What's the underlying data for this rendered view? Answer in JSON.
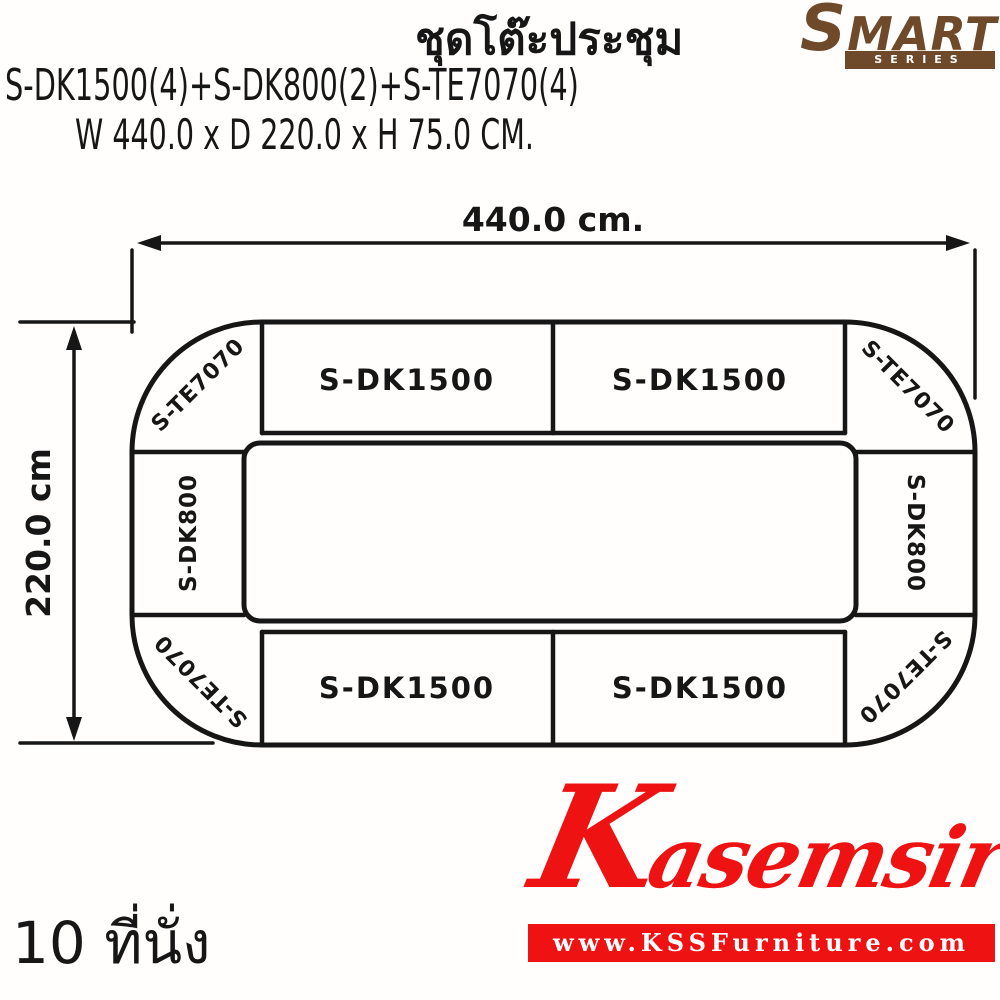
{
  "page": {
    "background_color": "#ffffff",
    "ink_color": "#161616"
  },
  "header": {
    "title": "ชุดโต๊ะประชุม",
    "product_code": "S-DK1500(4)+S-DK800(2)+S-TE7070(4)",
    "size_text": "W 440.0 x D 220.0 x H 75.0 CM.",
    "brand": {
      "name_initial": "S",
      "name_rest": "MART",
      "series": "SERIES",
      "color": "#6e4a2b"
    }
  },
  "diagram": {
    "type": "conference-table-layout-plan",
    "width_label": "440.0 cm.",
    "depth_label": "220.0 cm",
    "segments": {
      "top_left_corner": "S-TE7070",
      "top_segment_1": "S-DK1500",
      "top_segment_2": "S-DK1500",
      "top_right_corner": "S-TE7070",
      "left_side": "S-DK800",
      "right_side": "S-DK800",
      "bottom_left_corner": "S-TE7070",
      "bottom_segment_1": "S-DK1500",
      "bottom_segment_2": "S-DK1500",
      "bottom_right_corner": "S-TE7070"
    }
  },
  "footer": {
    "seats": "10 ที่นั่ง",
    "logo": {
      "script_initial": "K",
      "script_rest": "asemsiri",
      "website": "www.KSSFurniture.com",
      "color": "#ee1212"
    }
  }
}
